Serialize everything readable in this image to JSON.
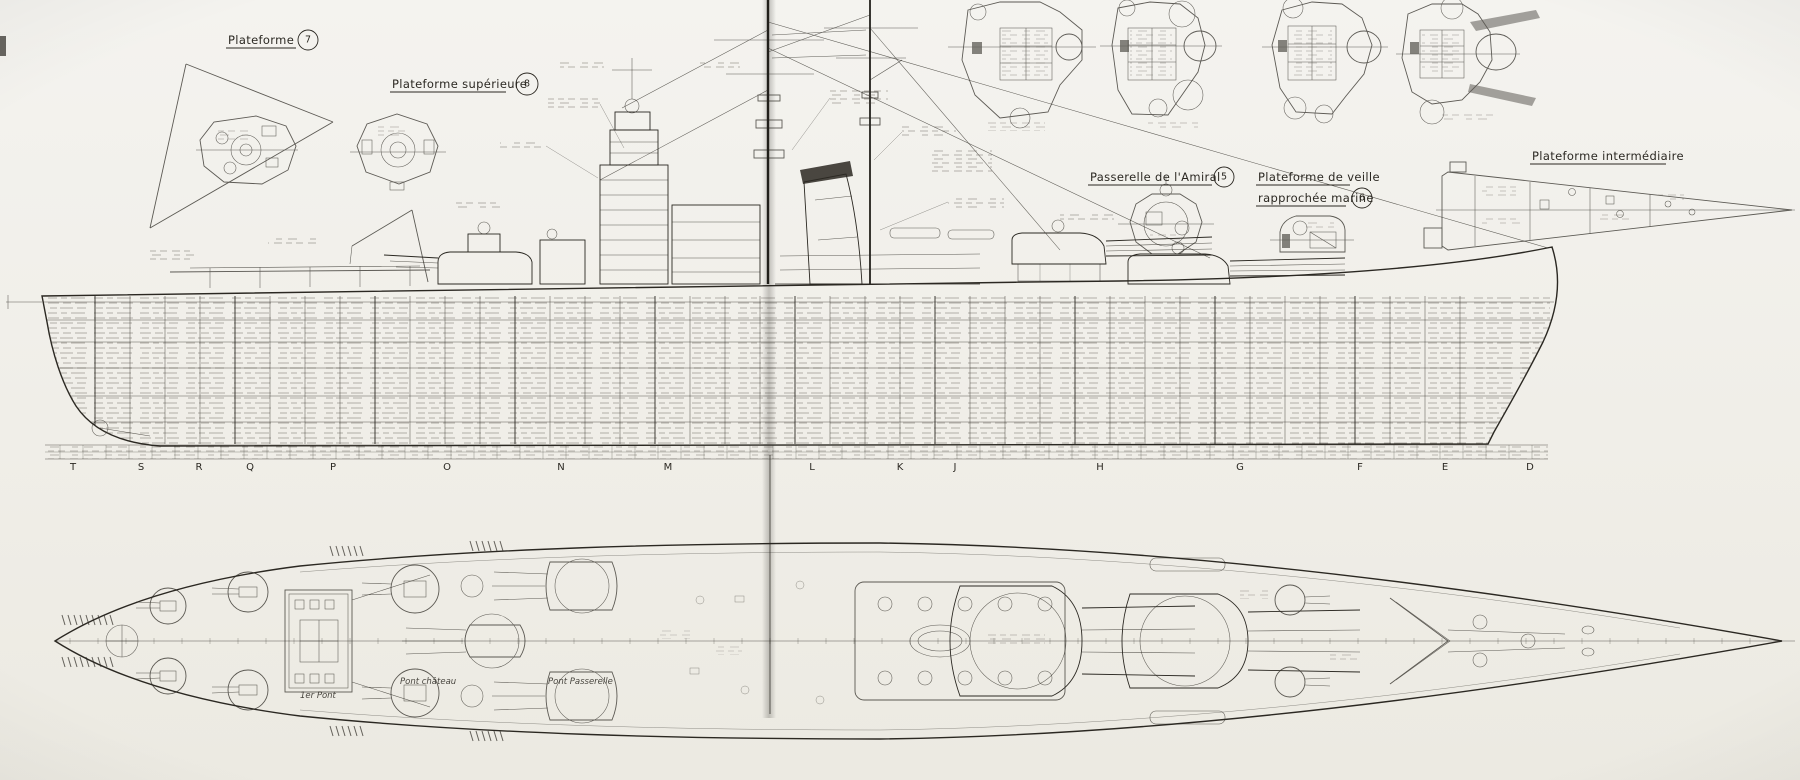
{
  "annotations": {
    "plateforme_7": {
      "label": "Plateforme",
      "number": "7"
    },
    "plateforme_superieure_8": {
      "label": "Plateforme supérieure",
      "number": "8"
    },
    "passerelle_amiral_5": {
      "label": "Passerelle de l'Amiral",
      "number": "5"
    },
    "plateforme_veille_6": {
      "line1": "Plateforme de veille",
      "line2": "rapprochée marine",
      "number": "6"
    },
    "plateforme_intermediaire": {
      "label": "Plateforme intermédiaire"
    }
  },
  "profile_view": {
    "station_letters": [
      "T",
      "S",
      "R",
      "Q",
      "P",
      "O",
      "N",
      "M",
      "L",
      "K",
      "J",
      "H",
      "G",
      "F",
      "E",
      "D"
    ]
  },
  "plan_view": {
    "deck_labels": [
      {
        "text": "1er Pont"
      },
      {
        "text": "Pont château"
      },
      {
        "text": "Pont Passerelle"
      }
    ]
  },
  "colors": {
    "paper": "#f1efe9",
    "ink": "#2b2822"
  }
}
